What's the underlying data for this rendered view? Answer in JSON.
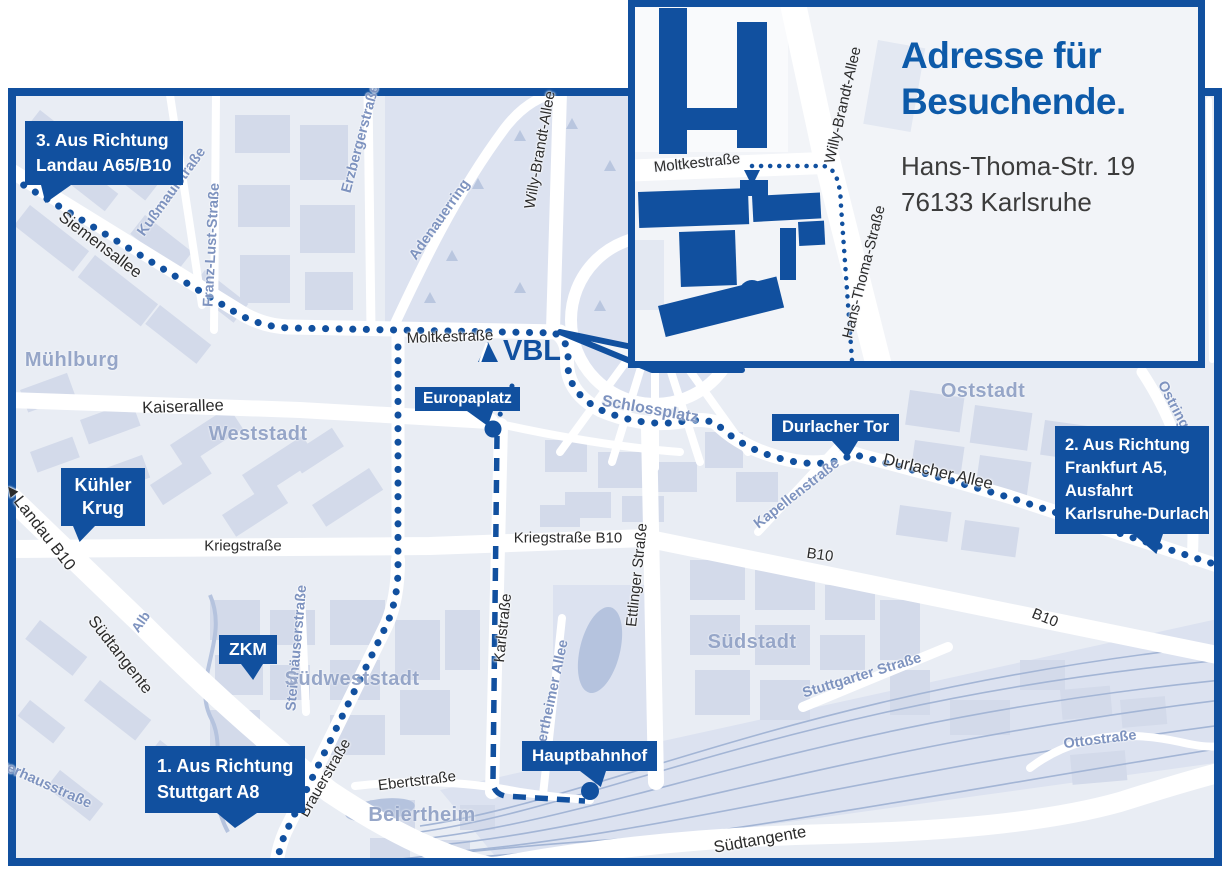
{
  "inset": {
    "title": [
      "Adresse für",
      "Besuchende."
    ],
    "address": [
      "Hans-Thoma-Str. 19",
      "76133 Karlsruhe"
    ],
    "streets": [
      "Moltkestraße",
      "Willy-Brandt-Allee",
      "Hans-Thoma-Straße"
    ]
  },
  "logo": {
    "text": "VBL"
  },
  "callouts": [
    {
      "lines": [
        "3. Aus Richtung",
        "Landau A65/B10"
      ]
    },
    {
      "lines": [
        "Kühler",
        "Krug"
      ]
    },
    {
      "lines": [
        "ZKM"
      ]
    },
    {
      "lines": [
        "1. Aus Richtung",
        "Stuttgart A8"
      ]
    },
    {
      "lines": [
        "Europaplatz"
      ]
    },
    {
      "lines": [
        "Hauptbahnhof"
      ]
    },
    {
      "lines": [
        "Durlacher Tor"
      ]
    },
    {
      "lines": [
        "2. Aus Richtung",
        "Frankfurt A5,",
        "Ausfahrt",
        "Karlsruhe-Durlach"
      ]
    }
  ],
  "map": {
    "streets": [
      "Siemensallee",
      "Moltkestraße",
      "Kaiserallee",
      "Kriegstraße",
      "Kriegstraße B10",
      "Karlstraße",
      "Ettlinger Straße",
      "Durlacher Allee",
      "B10",
      "B10",
      "Südtangente",
      "Südtangente",
      "Brauerstraße",
      "Ebertstraße",
      "Landau B10",
      "Willy-Brandt-Allee",
      "Kußmaulstraße",
      "Franz-Lust-Straße",
      "Erzbergerstraße",
      "Adenauerring",
      "Schlossplatz",
      "Kapellenstraße",
      "Ostring",
      "Stuttgarter Straße",
      "Ottostraße",
      "Steinhäuserstraße",
      "Beiertheimer Allee",
      "Alb",
      "Pulverhausstraße"
    ],
    "districts": [
      "Mühlburg",
      "Weststadt",
      "Südweststadt",
      "Beiertheim",
      "Südstadt",
      "Oststadt"
    ],
    "landau_arrow": "◀"
  },
  "colors": {
    "brand_blue": "#11509f",
    "title_blue": "#0d5aa9",
    "map_bg": "#e9edf4",
    "block": "#d3daea",
    "park": "#dce2f0",
    "district_text": "#96a6c8",
    "minor_street_text": "#7e93bf",
    "street_text": "#2b2b2b",
    "inset_bg": "#f2f4f8",
    "rail": "#a3b5d5",
    "water": "#b5c3de"
  }
}
